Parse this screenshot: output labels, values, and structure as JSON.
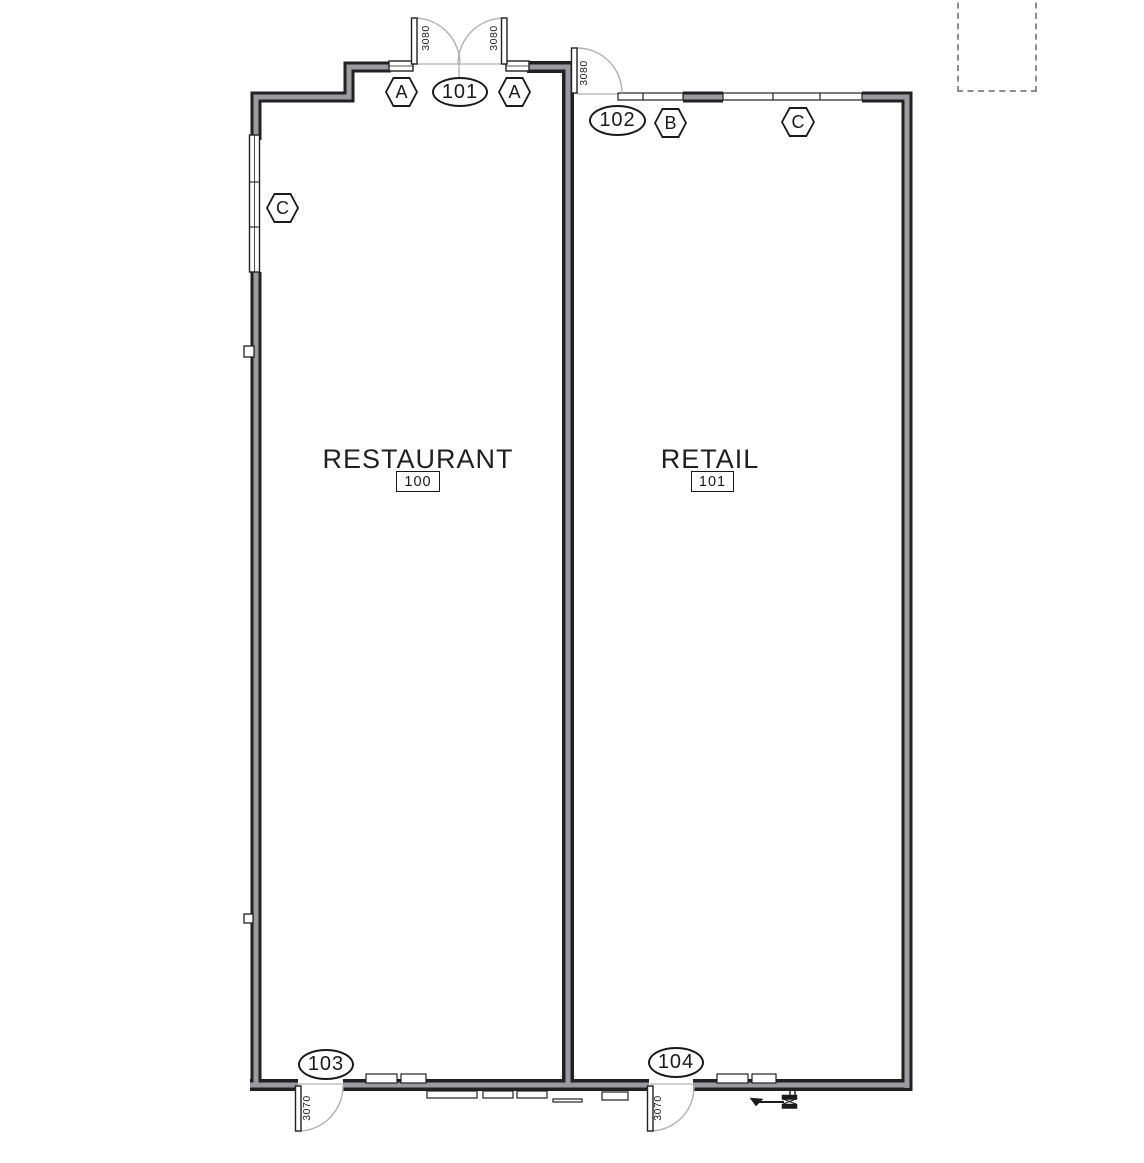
{
  "rooms": {
    "restaurant": {
      "name": "RESTAURANT",
      "number": "100"
    },
    "retail": {
      "name": "RETAIL",
      "number": "101"
    }
  },
  "door_tags": {
    "entry": "101",
    "retail_front": "102",
    "restaurant_rear": "103",
    "retail_rear": "104"
  },
  "window_tags": {
    "a": "A",
    "b": "B",
    "c": "C"
  },
  "dimensions": {
    "entry_leaf_left": "3080",
    "entry_leaf_right": "3080",
    "door_102": "3080",
    "door_103": "3070",
    "door_104": "3070"
  },
  "colors": {
    "wall_edge": "#212121",
    "wall_core": "#9a9aa0",
    "swing_arc": "#b2b2b2",
    "text": "#1a1a1a"
  }
}
